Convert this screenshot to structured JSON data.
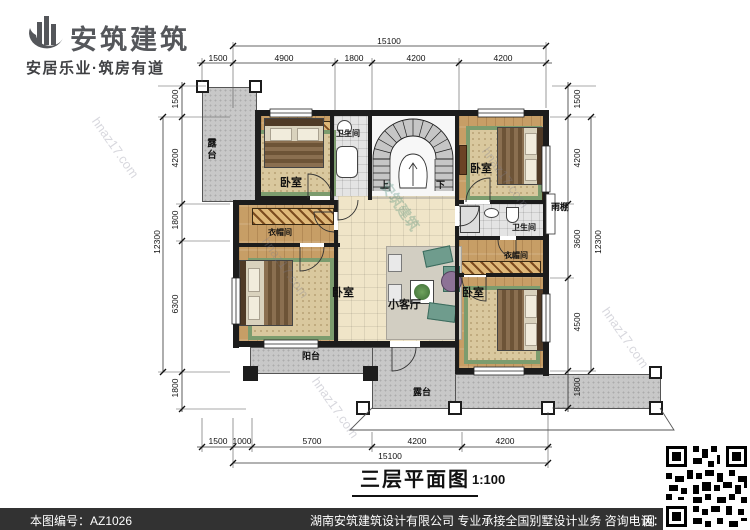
{
  "brand": {
    "name": "安筑建筑",
    "tagline": "安居乐业·筑房有道"
  },
  "rooms": {
    "terrace_top": "露台",
    "bedroom_tl": "卧室",
    "bath_top": "卫生间",
    "bedroom_tr": "卧室",
    "canopy": "雨棚",
    "closet_left": "衣帽间",
    "bath_right": "卫生间",
    "closet_right": "衣帽间",
    "bedroom_bl": "卧室",
    "living": "小客厅",
    "bedroom_br": "卧室",
    "balcony": "阳台",
    "terrace_bottom": "露台"
  },
  "stairs": {
    "up": "上",
    "down": "下"
  },
  "dimensions": {
    "top": {
      "overall": "15100",
      "segments": [
        "1500",
        "4900",
        "1800",
        "4200",
        "4200"
      ]
    },
    "bottom": {
      "overall": "15100",
      "segments": [
        "1500",
        "1000",
        "5700",
        "4200",
        "4200"
      ]
    },
    "left": {
      "overall": "12300",
      "segments": [
        "1500",
        "4200",
        "1800",
        "6300",
        "1800"
      ]
    },
    "right": {
      "overall": "12300",
      "segments": [
        "1500",
        "4200",
        "3600",
        "4500",
        "1800"
      ]
    }
  },
  "title_block": {
    "name": "三层平面图",
    "scale": "1:100"
  },
  "watermarks": {
    "site": "hnaz17.com",
    "brand": "安筑建筑"
  },
  "footer": {
    "serial": "本图编号：AZ1026",
    "company": "湖南安筑建筑设计有限公司  专业承接全国别墅设计业务  咨询电话：400-8070-511",
    "net": "网"
  },
  "colors": {
    "wall": "#1c1c1c",
    "wood_floor": "#c79e66",
    "tile_floor": "#f0e5c8",
    "bath_tile": "#e4e4e4",
    "outdoor_gray": "#c8c8c8",
    "rug_green": "#7c9c6e",
    "rug_beige": "#d9c89e",
    "footer_bar": "#323232",
    "brand_gray": "#55575b"
  }
}
